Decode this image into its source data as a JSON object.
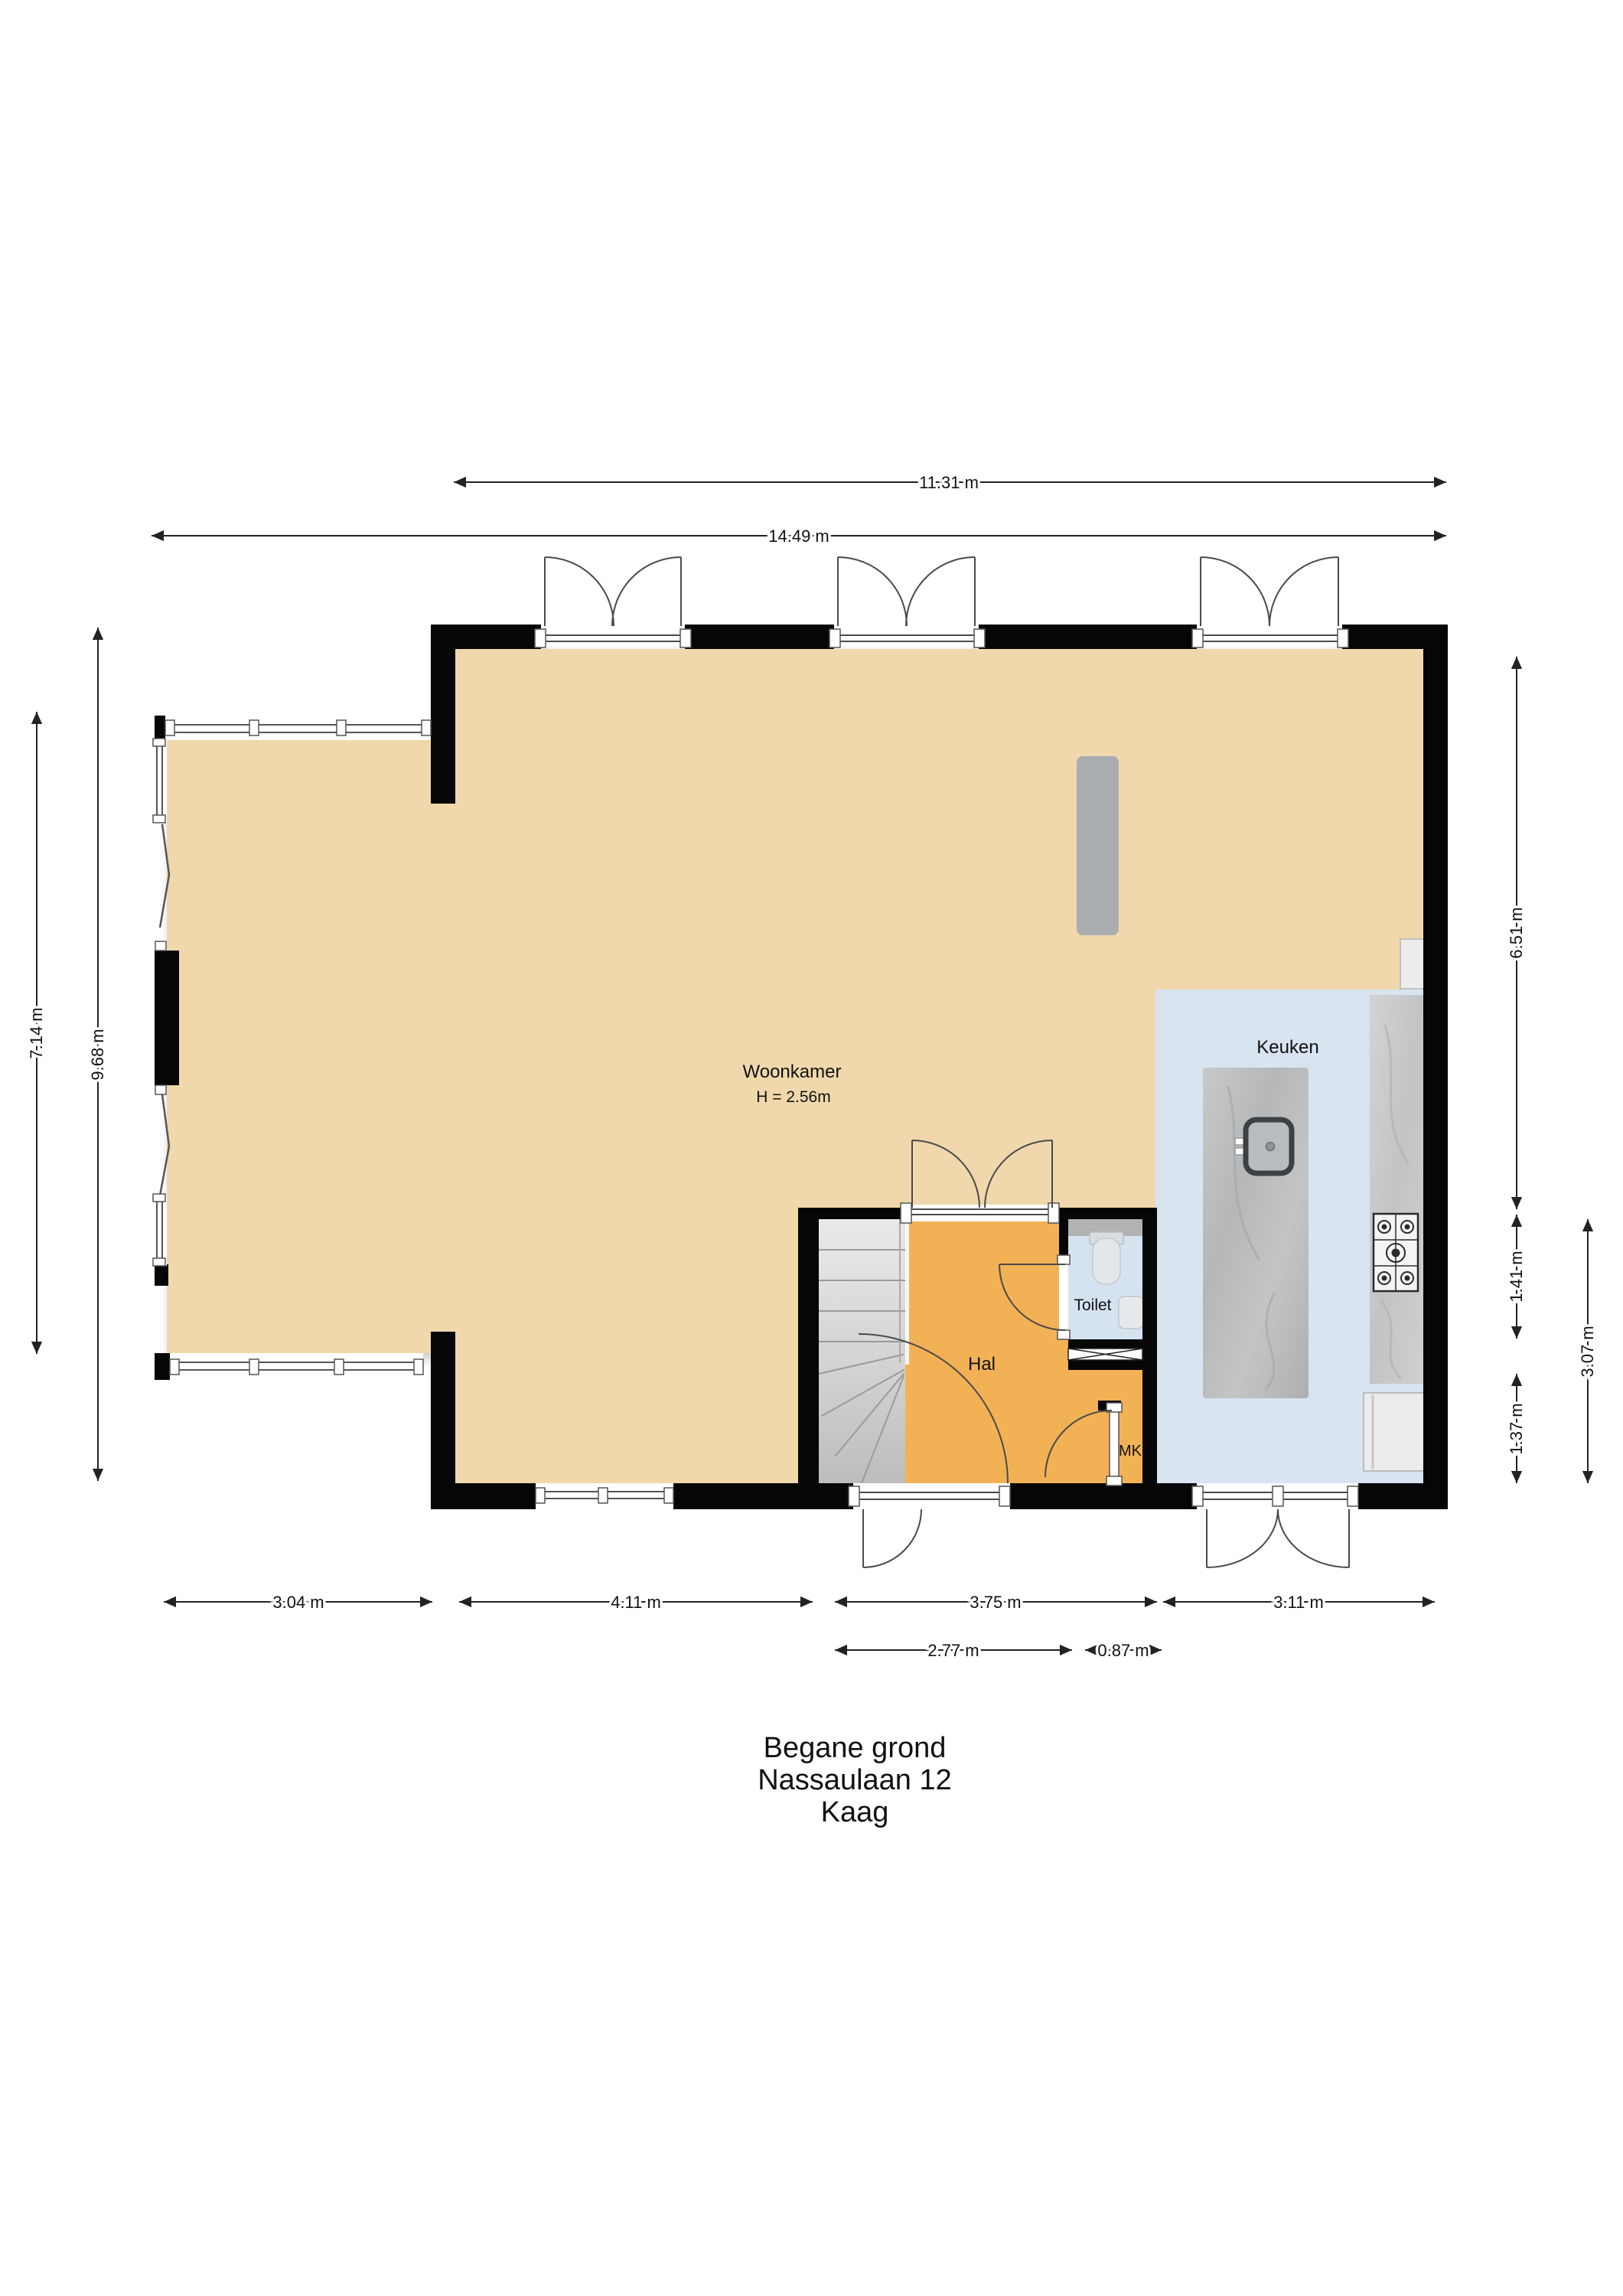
{
  "title": {
    "line1": "Begane grond",
    "line2": "Nassaulaan 12",
    "line3": "Kaag"
  },
  "rooms": {
    "woonkamer": {
      "label": "Woonkamer",
      "height_note": "H = 2.56m"
    },
    "keuken": {
      "label": "Keuken"
    },
    "hal": {
      "label": "Hal"
    },
    "toilet": {
      "label": "Toilet"
    },
    "mk": {
      "label": "MK"
    }
  },
  "dimensions": {
    "top_inner": "11.31 m",
    "top_outer": "14.49 m",
    "left_inner": "7.14 m",
    "left_outer": "9.68 m",
    "right_upper": "6.51 m",
    "right_mid": "1.41 m",
    "right_lower": "1.37 m",
    "right_outer": "3.07 m",
    "bottom_1": "3.04 m",
    "bottom_2": "4.11 m",
    "bottom_3": "3.75 m",
    "bottom_4": "3.11 m",
    "bottom_sub_1": "2.77 m",
    "bottom_sub_2": "0.87 m"
  },
  "colors": {
    "floor_living": "#f0d8ac",
    "floor_hall": "#f3b156",
    "floor_kitchen": "#d8e4f0",
    "wall": "#060606",
    "stairs": "#d8d8d8",
    "counter": "#c9cbcc",
    "dimension_line": "#222222"
  }
}
